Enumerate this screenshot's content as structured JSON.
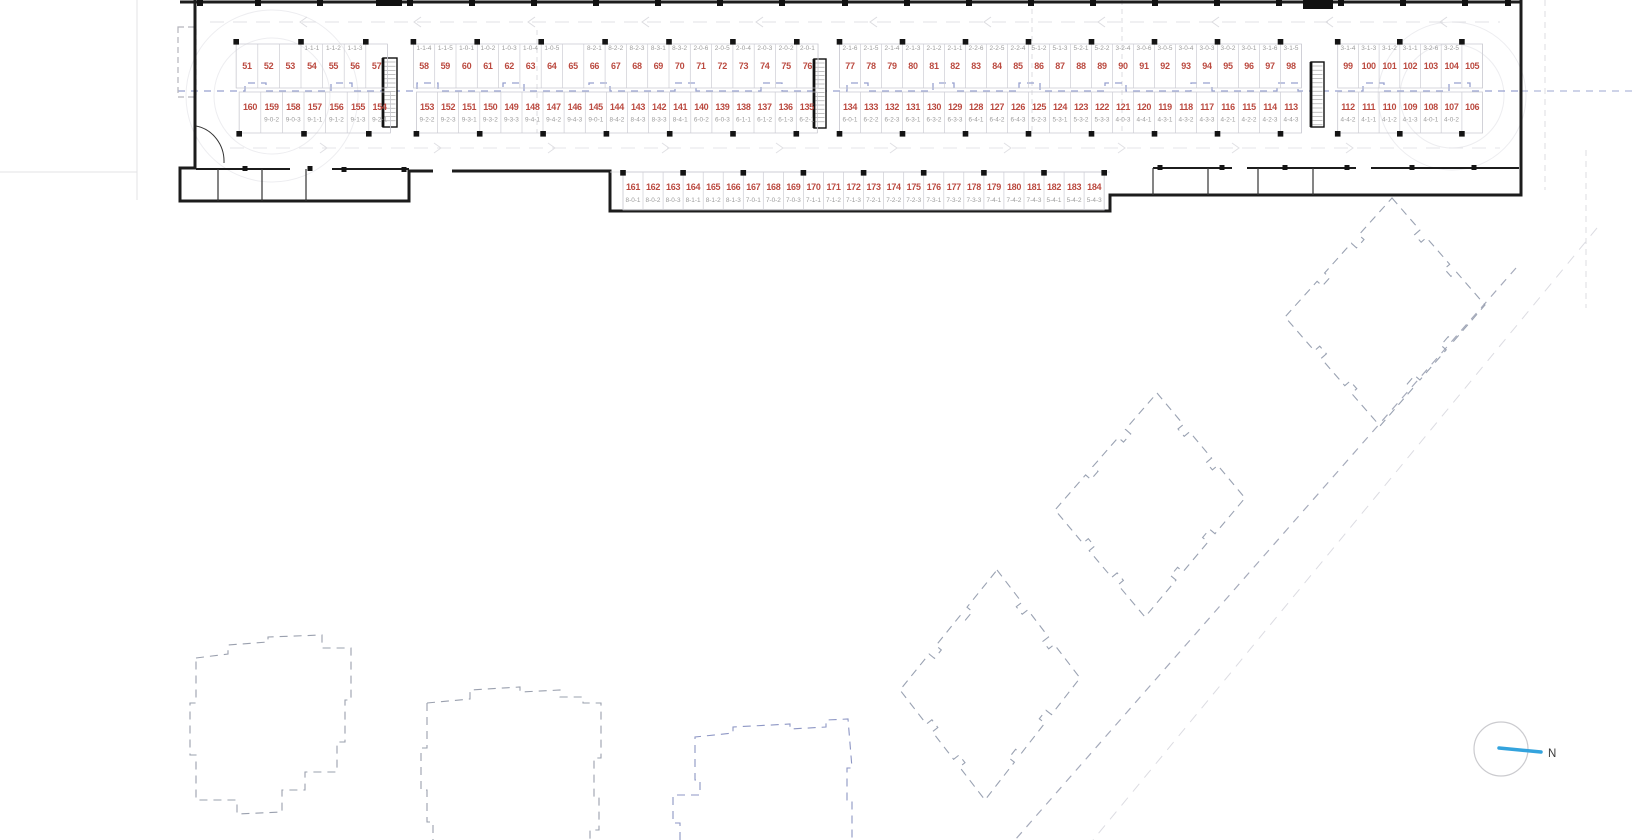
{
  "compass": {
    "label": "N"
  },
  "colors": {
    "stall_number": "#bb4a40",
    "unit_code": "#9b9b9b",
    "centerline_blue": "#97a1cf",
    "wall_black": "#1c1c1c",
    "building_outline_gray": "#9aa2b2",
    "building_outline_blue": "#8d96c4",
    "compass_blue": "#33a3dd"
  },
  "rows": {
    "top": [
      {
        "numbers": [
          "51",
          "52",
          "53",
          "54",
          "55",
          "56",
          "57"
        ],
        "codes": [
          "",
          "",
          "",
          "1-1-1",
          "1-1-2",
          "1-1-3",
          ""
        ]
      },
      {
        "numbers": [
          "58",
          "59",
          "60",
          "61",
          "62",
          "63",
          "64",
          "65",
          "66",
          "67",
          "68",
          "69",
          "70",
          "71",
          "72",
          "73",
          "74",
          "75",
          "76"
        ],
        "codes": [
          "1-1-4",
          "1-1-5",
          "1-0-1",
          "1-0-2",
          "1-0-3",
          "1-0-4",
          "1-0-5",
          "",
          "8-2-1",
          "8-2-2",
          "8-2-3",
          "8-3-1",
          "8-3-2",
          "2-0-6",
          "2-0-5",
          "2-0-4",
          "2-0-3",
          "2-0-2",
          "2-0-1"
        ]
      },
      {
        "numbers": [
          "77",
          "78",
          "79",
          "80",
          "81",
          "82",
          "83",
          "84",
          "85",
          "86",
          "87",
          "88",
          "89",
          "90",
          "91",
          "92",
          "93",
          "94",
          "95",
          "96",
          "97",
          "98"
        ],
        "codes": [
          "2-1-6",
          "2-1-5",
          "2-1-4",
          "2-1-3",
          "2-1-2",
          "2-1-1",
          "2-2-6",
          "2-2-5",
          "2-2-4",
          "5-1-2",
          "5-1-3",
          "5-2-1",
          "5-2-2",
          "3-2-4",
          "3-0-6",
          "3-0-5",
          "3-0-4",
          "3-0-3",
          "3-0-2",
          "3-0-1",
          "3-1-6",
          "3-1-5"
        ]
      },
      {
        "numbers": [
          "99",
          "100",
          "101",
          "102",
          "103",
          "104",
          "105"
        ],
        "codes": [
          "3-1-4",
          "3-1-3",
          "3-1-2",
          "3-1-1",
          "3-2-6",
          "3-2-5",
          ""
        ]
      }
    ],
    "bottom": [
      {
        "numbers": [
          "160",
          "159",
          "158",
          "157",
          "156",
          "155",
          "154"
        ],
        "codes": [
          "",
          "9-0-2",
          "9-0-3",
          "9-1-1",
          "9-1-2",
          "9-1-3",
          "9-2-1"
        ]
      },
      {
        "numbers": [
          "153",
          "152",
          "151",
          "150",
          "149",
          "148",
          "147",
          "146",
          "145",
          "144",
          "143",
          "142",
          "141",
          "140",
          "139",
          "138",
          "137",
          "136",
          "135"
        ],
        "codes": [
          "9-2-2",
          "9-2-3",
          "9-3-1",
          "9-3-2",
          "9-3-3",
          "9-4-1",
          "9-4-2",
          "9-4-3",
          "9-0-1",
          "8-4-2",
          "8-4-3",
          "8-3-3",
          "8-4-1",
          "6-0-2",
          "6-0-3",
          "6-1-1",
          "6-1-2",
          "6-1-3",
          "6-2-1"
        ]
      },
      {
        "numbers": [
          "134",
          "133",
          "132",
          "131",
          "130",
          "129",
          "128",
          "127",
          "126",
          "125",
          "124",
          "123",
          "122",
          "121",
          "120",
          "119",
          "118",
          "117",
          "116",
          "115",
          "114",
          "113"
        ],
        "codes": [
          "6-0-1",
          "6-2-2",
          "6-2-3",
          "6-3-1",
          "6-3-2",
          "6-3-3",
          "6-4-1",
          "6-4-2",
          "6-4-3",
          "5-2-3",
          "5-3-1",
          "5-3-2",
          "5-3-3",
          "4-0-3",
          "4-4-1",
          "4-3-1",
          "4-3-2",
          "4-3-3",
          "4-2-1",
          "4-2-2",
          "4-2-3",
          "4-4-3"
        ]
      },
      {
        "numbers": [
          "112",
          "111",
          "110",
          "109",
          "108",
          "107",
          "106"
        ],
        "codes": [
          "4-4-2",
          "4-1-1",
          "4-1-2",
          "4-1-3",
          "4-0-1",
          "4-0-2",
          ""
        ]
      }
    ],
    "annex": [
      {
        "numbers": [
          "161",
          "162",
          "163",
          "164",
          "165",
          "166",
          "167",
          "168",
          "169",
          "170",
          "171",
          "172",
          "173",
          "174",
          "175",
          "176",
          "177",
          "178",
          "179",
          "180",
          "181",
          "182",
          "183",
          "184"
        ],
        "codes": [
          "8-0-1",
          "8-0-2",
          "8-0-3",
          "8-1-1",
          "8-1-2",
          "8-1-3",
          "7-0-1",
          "7-0-2",
          "7-0-3",
          "7-1-1",
          "7-1-2",
          "7-1-3",
          "7-2-1",
          "7-2-2",
          "7-2-3",
          "7-3-1",
          "7-3-2",
          "7-3-3",
          "7-4-1",
          "7-4-2",
          "7-4-3",
          "5-4-1",
          "5-4-2",
          "5-4-3"
        ]
      }
    ]
  }
}
